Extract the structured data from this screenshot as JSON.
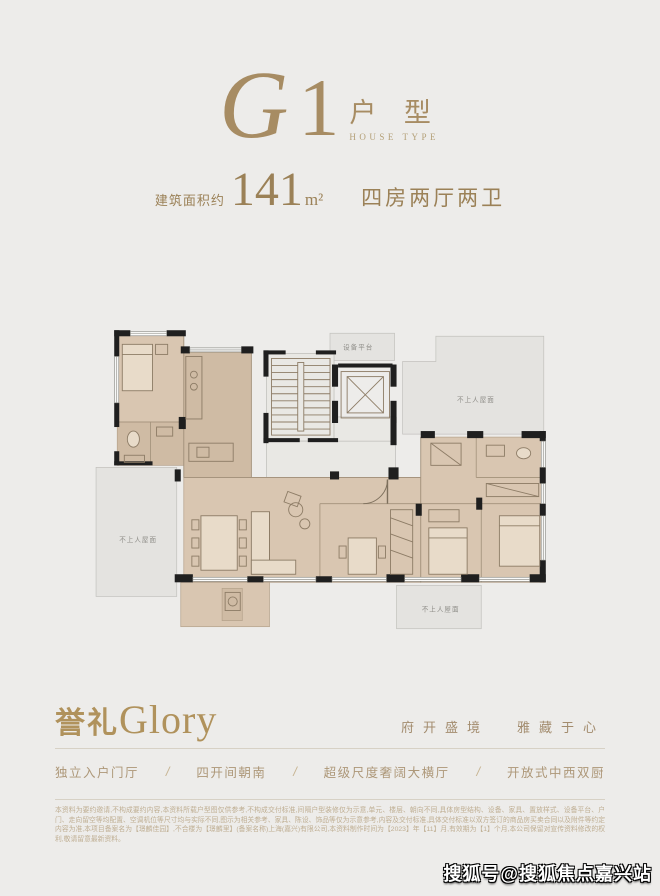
{
  "header": {
    "model_g": "G",
    "model_1": "1",
    "type_cn": "户 型",
    "type_en": "HOUSE TYPE"
  },
  "area": {
    "prefix": "建筑面积约",
    "value": "141",
    "unit": "m²",
    "layout": "四房两厅两卫"
  },
  "floorplan": {
    "equipment_platform": "设备平台",
    "roof_label": "不上人屋面"
  },
  "brand": {
    "cn": "誉礼",
    "en": "Glory",
    "tagline_left": "府开盛境",
    "tagline_right": "雅藏于心"
  },
  "features": {
    "separator": "/",
    "items": [
      "独立入户门厅",
      "四开间朝南",
      "超级尺度奢阔大横厅",
      "开放式中西双厨"
    ]
  },
  "disclaimer": "本资料为要约邀请,不构成要约内容,本资料所载户型图仅供参考,不构成交付标准,间隔户型装修仅为示意,单元、楼层、朝向不同,具体房型结构、设备、家具、置放样式、设备平台、户门、走向留空等均配置、空调机位等尺寸均与实际不同,图示为相关参考、家具、陈设、饰品等仅为示意参考,内容及交付标准,具体交付标准以双方签订的商品房买卖合同以及附件等约定内容为准,本项目备案名为【璟麟佳园】,不合楼为【璟麟里】(备案名称)上海(嘉兴)有限公司,本资料制作时间为【2023】年【11】月,有效期为【1】个月,本公司保留对宣传资料修改的权利,敬请留意最新资料。",
  "watermark": "搜狐号@搜狐焦点嘉兴站"
}
